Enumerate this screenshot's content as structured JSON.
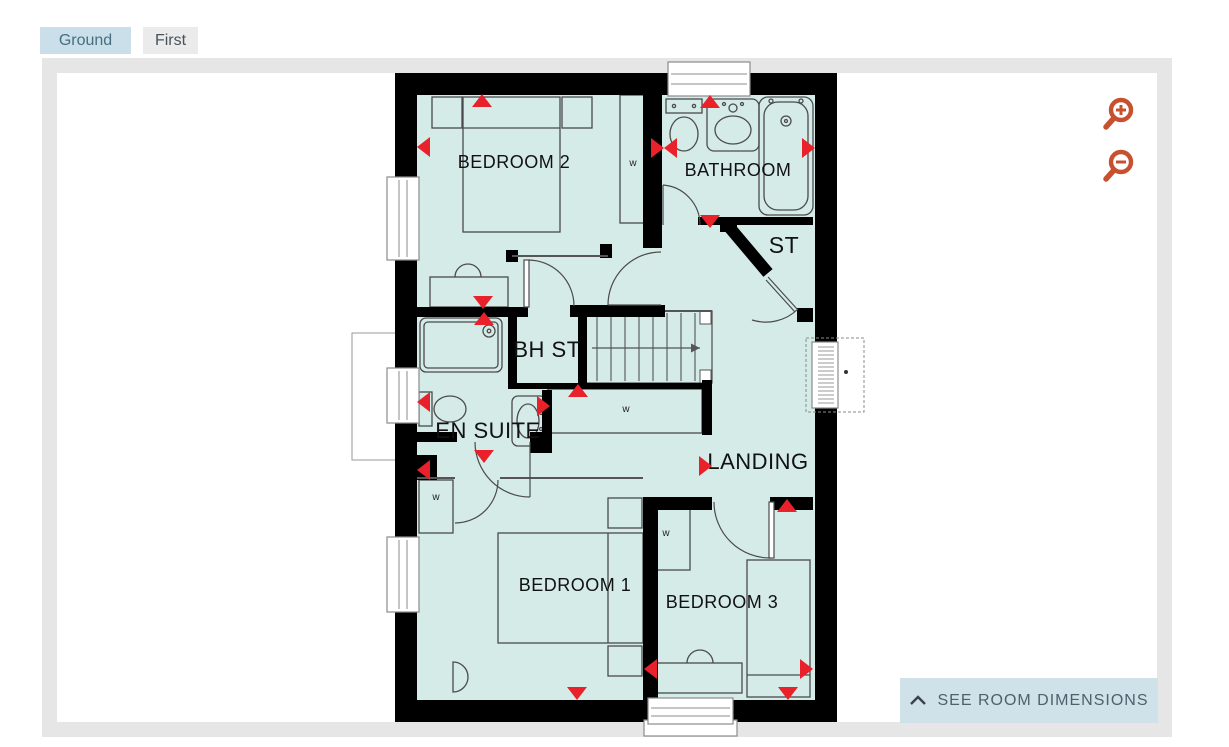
{
  "tabs": [
    {
      "label": "Ground",
      "active": true
    },
    {
      "label": "First",
      "active": false
    }
  ],
  "plan": {
    "rooms": [
      "BEDROOM 2",
      "BATHROOM",
      "ST",
      "BH ST",
      "EN SUITE",
      "LANDING",
      "BEDROOM 1",
      "BEDROOM 3"
    ],
    "wardrobe_marker": "w",
    "stairs_icon": "stairs-up-arrow",
    "dimension_marker_icon": "red-triangle",
    "room_fill_color": "#d5ebe7",
    "wall_color": "#000000",
    "marker_color": "#e8212a"
  },
  "controls": {
    "zoom_in_icon": "magnifier-plus",
    "zoom_out_icon": "magnifier-minus",
    "zoom_icon_color": "#c7502f",
    "dimensions_button": {
      "chevron_icon": "chevron-up",
      "label": "SEE ROOM DIMENSIONS",
      "bg_color": "#cfe2ea",
      "text_color": "#515f69"
    }
  },
  "frame_color": "#e6e6e6",
  "tab_colors": {
    "active_bg": "#cadfe9",
    "active_text": "#45707f",
    "inactive_bg": "#ebebeb",
    "inactive_text": "#47525c"
  }
}
